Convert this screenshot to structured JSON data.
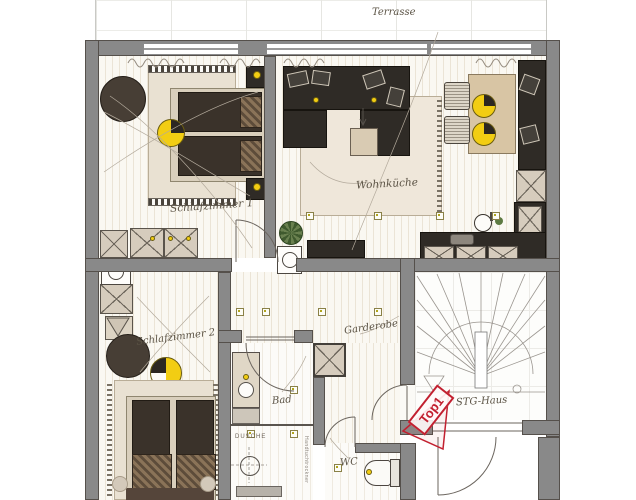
{
  "plan": {
    "terrace": {
      "label": "Terrasse"
    },
    "rooms": {
      "schlafzimmer1": "Schlafzimmer 1",
      "wohnkueche": "Wohnküche",
      "schlafzimmer2": "Schlafzimmer 2",
      "garderobe": "Garderobe",
      "bad": "Bad",
      "wc": "WC",
      "stg_haus": "STG-Haus"
    },
    "annotations": {
      "unit_tag": "Top1",
      "dusche": "DUSCHE",
      "handtuchtrockner": "Handtuchtrockner"
    },
    "colors": {
      "wall_gray": "#898989",
      "furniture_dark": "#2f2b26",
      "bed_dark": "#3a322a",
      "rug_beige": "#e9e1d2",
      "cabinet_beige": "#d6ccbd",
      "accent_yellow": "#f2cd13",
      "tag_red": "#c22030",
      "plant_green": "#5d7a42",
      "label_ink": "#5b5345"
    }
  }
}
